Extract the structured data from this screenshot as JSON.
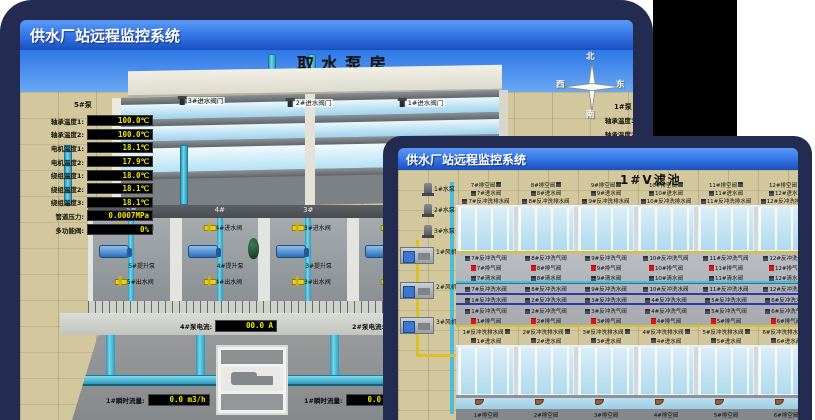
{
  "colors": {
    "desktop_navy": "#232c50",
    "titlebar_blue_top": "#5a9af5",
    "titlebar_blue_bottom": "#1850c0",
    "panel_black": "#000000",
    "ground_tan": "#d3c89d",
    "sky_blue": "#2e78e8",
    "water_blue": "#b0daee",
    "pipe_cyan": "#48bcd8",
    "pipe_yellow": "#d8c228",
    "pipe_dark_blue": "#3038b0",
    "valve_yellow": "#e8d020",
    "valve_red": "#d81818",
    "readout_bg": "#000000",
    "readout_text": "#f0e800"
  },
  "back_window": {
    "title": "供水厂站远程监控系统",
    "room_title": "取水泵房",
    "panel": {
      "header": "5#泵",
      "rows": [
        {
          "label": "轴承温度1:",
          "value": "100.0℃"
        },
        {
          "label": "轴承温度2:",
          "value": "100.0℃"
        },
        {
          "label": "电机温度1:",
          "value": "18.1℃"
        },
        {
          "label": "电机温度2:",
          "value": "17.9℃"
        },
        {
          "label": "绕组温度1:",
          "value": "18.0℃"
        },
        {
          "label": "绕组温度2:",
          "value": "18.1℃"
        },
        {
          "label": "绕组温度3:",
          "value": "18.1℃"
        },
        {
          "label": "管道压力:",
          "value": "0.0007MPa"
        },
        {
          "label": "多功能阀:",
          "value": "0%"
        }
      ]
    },
    "gates": [
      "3#进水阀门",
      "2#进水阀门",
      "1#进水阀门"
    ],
    "bays": [
      {
        "id": "5#",
        "inlet": "5#进水阀",
        "pump": "5#提升泵",
        "outlet": "5#出水阀"
      },
      {
        "id": "4#",
        "inlet": "4#进水阀",
        "pump": "4#提升泵",
        "outlet": "4#出水阀"
      },
      {
        "id": "3#",
        "inlet": "3#进水阀",
        "pump": "3#提升泵",
        "outlet": "3#出水阀"
      },
      {
        "id": "2#",
        "inlet": "2#进水阀",
        "pump": "2#提升泵",
        "outlet": "2#出水阀"
      }
    ],
    "currents": [
      {
        "label": "4#泵电流:",
        "value": "00.0 A"
      },
      {
        "label": "2#泵电流:",
        "value": ""
      }
    ],
    "flows": [
      {
        "label": "1#瞬时流量:",
        "value": "0.0 m3/h"
      },
      {
        "label": "1#瞬时流量:",
        "value": "0.0 m3/h"
      }
    ],
    "compass": {
      "n": "北",
      "s": "南",
      "e": "东",
      "w": "西"
    },
    "right_panel": {
      "header": "1#泵",
      "rows": [
        "轴承温度1:",
        "轴承温度2:"
      ]
    }
  },
  "front_window": {
    "title": "供水厂站远程监控系统",
    "room_title": "1#V滤池",
    "pumps": [
      "1#水泵",
      "2#水泵",
      "3#水泵"
    ],
    "blowers": [
      "1#风机",
      "2#风机",
      "3#风机"
    ],
    "top_cells": [
      {
        "drain": "7#排空阀",
        "inlet": "7#进水阀",
        "washout": "7#反冲洗排水阀",
        "air": "7#反冲洗气阀",
        "vent": "7#排气阀",
        "clean": "7#清水阀",
        "wash": "7#反冲洗水阀"
      },
      {
        "drain": "8#排空阀",
        "inlet": "8#进水阀",
        "washout": "8#反冲洗排水阀",
        "air": "8#反冲洗气阀",
        "vent": "8#排气阀",
        "clean": "8#清水阀",
        "wash": "8#反冲洗水阀"
      },
      {
        "drain": "9#排空阀",
        "inlet": "9#进水阀",
        "washout": "9#反冲洗排水阀",
        "air": "9#反冲洗气阀",
        "vent": "9#排气阀",
        "clean": "9#清水阀",
        "wash": "9#反冲洗水阀"
      },
      {
        "drain": "10#排空阀",
        "inlet": "10#进水阀",
        "washout": "10#反冲洗排水阀",
        "air": "10#反冲洗气阀",
        "vent": "10#排气阀",
        "clean": "10#清水阀",
        "wash": "10#反冲洗水阀"
      },
      {
        "drain": "11#排空阀",
        "inlet": "11#进水阀",
        "washout": "11#反冲洗排水阀",
        "air": "11#反冲洗气阀",
        "vent": "11#排气阀",
        "clean": "11#清水阀",
        "wash": "11#反冲洗水阀"
      },
      {
        "drain": "12#排空阀",
        "inlet": "12#进水阀",
        "washout": "12#反冲洗排水阀",
        "air": "12#反冲洗气阀",
        "vent": "12#排气阀",
        "clean": "12#清水阀",
        "wash": "12#反冲洗水阀"
      }
    ],
    "bottom_cells": [
      {
        "wash": "1#反冲洗水阀",
        "air": "1#反冲洗气阀",
        "vent": "1#排气阀",
        "washout": "1#反冲洗排水阀",
        "inlet": "1#进水阀",
        "drain": "1#排空阀"
      },
      {
        "wash": "2#反冲洗水阀",
        "air": "2#反冲洗气阀",
        "vent": "2#排气阀",
        "washout": "2#反冲洗排水阀",
        "inlet": "2#进水阀",
        "drain": "2#排空阀"
      },
      {
        "wash": "3#反冲洗水阀",
        "air": "3#反冲洗气阀",
        "vent": "3#排气阀",
        "washout": "3#反冲洗排水阀",
        "inlet": "3#进水阀",
        "drain": "3#排空阀"
      },
      {
        "wash": "4#反冲洗水阀",
        "air": "4#反冲洗气阀",
        "vent": "4#排气阀",
        "washout": "4#反冲洗排水阀",
        "inlet": "4#进水阀",
        "drain": "4#排空阀"
      },
      {
        "wash": "5#反冲洗水阀",
        "air": "5#反冲洗气阀",
        "vent": "5#排气阀",
        "washout": "5#反冲洗排水阀",
        "inlet": "5#进水阀",
        "drain": "5#排空阀"
      },
      {
        "wash": "6#反冲洗水阀",
        "air": "6#反冲洗气阀",
        "vent": "6#排气阀",
        "washout": "6#反冲洗排水阀",
        "inlet": "6#进水阀",
        "drain": "6#排空阀"
      }
    ]
  }
}
